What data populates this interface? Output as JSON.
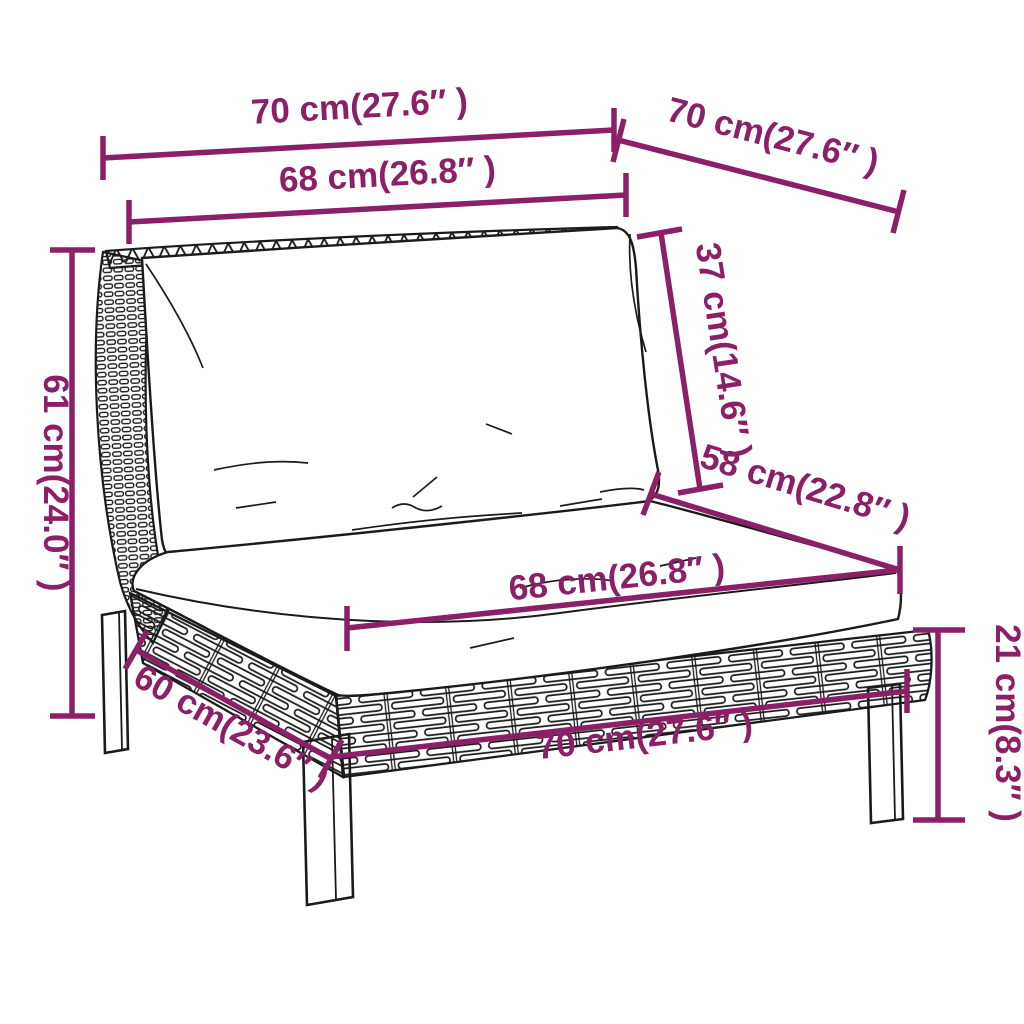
{
  "colors": {
    "annotation_purple": "#8c2067",
    "line_art": "#1b1b1b",
    "background": "#ffffff",
    "cushion_fill": "#ffffff"
  },
  "diagram": {
    "type": "furniture dimension diagram",
    "subject": "poly rattan garden sofa middle section with back cushion and seat cushion",
    "dimensions": [
      {
        "id": "back-top-width",
        "label": "70 cm(27.6″ )"
      },
      {
        "id": "top-depth",
        "label": "70 cm(27.6″ )"
      },
      {
        "id": "back-cushion-width",
        "label": "68 cm(26.8″ )"
      },
      {
        "id": "backrest-height",
        "label": "37 cm(14.6″ )"
      },
      {
        "id": "seat-depth",
        "label": "58 cm(22.8″ )"
      },
      {
        "id": "overall-height",
        "label": "61 cm(24.0″ )"
      },
      {
        "id": "seat-cushion-width",
        "label": "68 cm(26.8″ )"
      },
      {
        "id": "base-side-depth",
        "label": "60 cm(23.6″ )"
      },
      {
        "id": "base-front-width",
        "label": "70 cm(27.6″ )"
      },
      {
        "id": "leg-height",
        "label": "21 cm(8.3″ )"
      }
    ]
  }
}
